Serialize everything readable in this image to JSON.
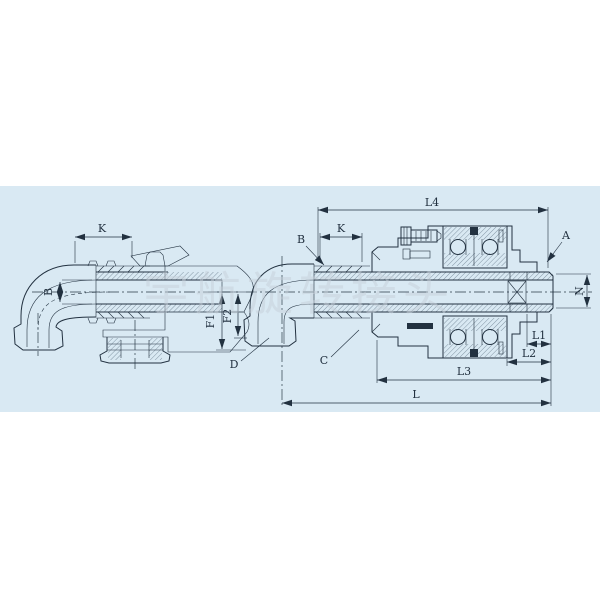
{
  "page": {
    "background": "#ffffff"
  },
  "panel": {
    "color": "#d9e9f3"
  },
  "watermark": {
    "text": "宇航旋转接头"
  },
  "left_view": {
    "k": "K",
    "b": "B"
  },
  "right_view": {
    "l4": "L4",
    "k": "K",
    "b": "B",
    "a": "A",
    "n": "N",
    "l1": "L1",
    "l2": "L2",
    "l3": "L3",
    "l": "L",
    "f1": "F1",
    "f2": "F2",
    "d": "D",
    "c": "C"
  }
}
